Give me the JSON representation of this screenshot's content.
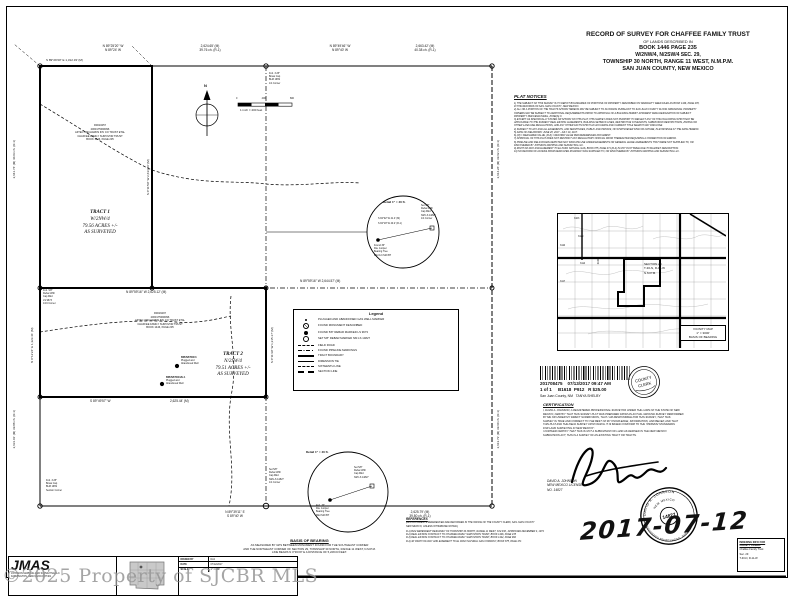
{
  "sheet": {
    "watermark": "©2025 Property of SJCBR MLS"
  },
  "title_block": {
    "line1": "RECORD OF SURVEY FOR CHAFFEE FAMILY TRUST",
    "line2": "OF LANDS DESCRIBED IN",
    "line3": "BOOK 1446 PAGE 235",
    "line4": "W/2NW/4, N/2SW/4 SEC. 29,",
    "line5": "TOWNSHIP 30 NORTH, RANGE 11 WEST, N.M.P.M.",
    "line6": "SAN JUAN COUNTY, NEW MEXICO"
  },
  "plat_notices": {
    "header": "PLAT NOTICES",
    "lines": [
      "1) THE SUBJECT OF THIS SURVEY IS TO DEPICT BOUNDARIES OF PORTIONS OF PROPERTY DESCRIBED ON WARRANTY DEED FILED AS BOOK 1446, PAGE 235,",
      "IN THE RECORDS OF SAN JUAN COUNTY, NEW MEXICO.",
      "2) ALL OR A PORTION OF THE TRACTS SHOWN HEREON MAY BE SUBJECT TO FLOODING PURSUANT TO SAN JUAN COUNTY FLOOD ORDINANCE. PROPERTY",
      "OWNERS MAY BE SUBJECT TO ADDITIONAL REQUIREMENTS PRIOR TO APPROVAL OF A BUILDING PERMIT. APPARENT FEMA DESIGNATION OF SUBJECT",
      "PROPERTY PER FEMA PANEL, ZONE(S) X.",
      "3) EXCEPT AS SPECIFICALLY STATED OR SHOWN ON THIS PLAT, THIS SURVEY DOES NOT PURPORT TO REFLECT ANY OF THE FOLLOWING WHICH MAY BE",
      "APPLICABLE TO THE SUBJECT REAL ESTATE: EASEMENTS, BUILDING SETBACK LINES, RESTRICTIVE COVENANTS, SUBDIVISION RESTRICTIONS, ZONING OR",
      "OTHER LAND-USE REGULATIONS, AND ANY OTHER FACTS WHICH AN ACCURATE AND CURRENT TITLE SEARCH MAY DISCLOSE.",
      "4) SUBJECT TO ANY AND ALL EASEMENTS, AND SERVITUDES, PUBLIC AND PRIVATE, OF WHATSOEVER KIND OR NATURE, IN EXISTENCE AT THE DATE HEREOF.",
      "5) DATE OF FIELDWORK: JUNE 28, 2017 - JULY 10, 2017.",
      "6) (M) = MEASURED VALUE, (R-#) = RECORD VALUE PER REFERENCED DOCUMENT.",
      "7) APPROVAL OF THIS PLAT DOES NOT RESTRICT ANY REGULATORY OFFICIAL FROM THEREAFTER REQUIRING A CORRECTION OF ERROR.",
      "8) PIPELINE AND FIELD ROADS DEPICTED MAY INDICATE USE UNDER EASEMENTS OR GENERAL LEASE AGREEMENTS THAT WERE NOT SUPPLIED TO, OR",
      "DISCOVERED BY JOHNSON MAPPING AND SURVEYING LLC.",
      "9) RIGHT-OF-WAY AND EASEMENT TO EL PASO NATURAL GAS, BOOK 875, PAGE 471 (R-4) IS NOT PLOTTABLE DUE TO BLANKET DESCRIPTION.",
      "10) NO RECORD OF ACCESS FROM DEDICATED ROADWAY WAS SUPPLIED TO, OR DISCOVERED BY JOHNSON MAPPING AND SURVEYING LLC."
    ]
  },
  "vicinity_map": {
    "section_line1": "SECTION 29",
    "section_line2": "T-30-N, R-11-W",
    "section_line3": "N.M.P.M.",
    "caption_line1": "VICINITY MAP",
    "caption_line2": "1\" = 3000'",
    "caption_line3": "BASIS OF BEARING",
    "road_numbers": [
      "3103",
      "3129",
      "3110",
      "3114",
      "3100",
      "3117"
    ]
  },
  "recording_stamp": {
    "doc_number": "201708475",
    "datetime": "07/13/2017 09:47 AM",
    "pages": "1 of 1",
    "book": "B1618",
    "page": "P912",
    "fee": "R $25.00",
    "county": "San Juan County, NM",
    "clerk": "TANYA SHELBY",
    "seal_line1": "COUNTY",
    "seal_line2": "CLERK"
  },
  "certification": {
    "header": "CERTIFICATION",
    "lines": [
      "I, DAVID A. JOHNSON, A REGISTERED PROFESSIONAL SURVEYOR UNDER THE LAWS OF THE STATE OF NEW",
      "MEXICO, CERTIFY THAT THIS SURVEY PLAT WAS PREPARED FROM AN ACTUAL GROUND SURVEY PERFORMED",
      "BY ME OR UNDER MY DIRECT SUPERVISION, THAT I AM RESPONSIBLE FOR THIS SURVEY, THAT THIS",
      "SURVEY IS TRUE AND CORRECT TO THE BEST OF MY KNOWLEDGE, INFORMATION, AND BELIEF, AND THAT",
      "THIS PLAT AND THE FIELD SURVEY UPON WHICH IT IS BASED CONFORM TO THE \"MINIMUM STANDARDS",
      "FOR LAND SURVEYING IN NEW MEXICO\".",
      "I FURTHER CERTIFY THAT THIS IS NOT A SUBDIVISION OF LAND AS DEFINED IN THE NEW MEXICO",
      "SUBDIVISION ACT; THIS IS A SURVEY OF AN EXISTING TRACT OR TRACTS."
    ]
  },
  "surveyor": {
    "name": "DAVID A. JOHNSON",
    "license_line": "NEW MEXICO LICENSE",
    "license_no": "NO. 14827",
    "seal_name": "DAVID A. JOHNSON",
    "seal_state": "NEW MEXICO",
    "seal_number": "14827",
    "seal_title": "REGISTERED PROFESSIONAL SURVEYOR",
    "signed_date": "2017-07-12"
  },
  "indexing_box": {
    "line1": "INDEXING INFO FOR",
    "line2": "COUNTY CLERK:",
    "line3": "Chaffee Family Trust",
    "line4": "Sec. 29",
    "line5": "T-30-N, R-11-W"
  },
  "references": {
    "header": "REFERENCES",
    "intro": [
      "(ALL DOCUMENTS REFERENCED ARE RECORDED IN THE OFFICE OF THE COUNTY CLERK, SAN JUAN COUNTY",
      "NEW MEXICO, UNLESS OTHERWISE NOTED.)"
    ],
    "lines": [
      "R-1) BLM DEPENDENT RESURVEY OF TOWNSHIP 30 NORTH, RANGE 11 WEST, N.M.P.M., APPROVED DECEMBER 4, 1974",
      "R-2) REAL ESTATE CONTRACT TO CHAFFEE FAMILY SURVIVOR'S TRUST, BOOK 1446, PAGE 235",
      "R-3) REAL ESTATE CONTRACT TO CHAFFEE FAMILY SURVIVOR'S TRUST, BOOK 1442, PAGE 960",
      "R-4) 40' RIGHT-OF-WAY AND EASEMENT TO EL PASO NATURAL GAS COMPANY, BOOK 875, PAGE 471"
    ]
  },
  "basis_of_bearing": {
    "header": "BASIS OF BEARING",
    "lines": [
      "AS MEASURED BY GPS BETWEEN MONUMENT FOUND FOR THE SOUTHEAST CORNER",
      "AND THE NORTHEAST CORNER OF SECTION 29, TOWNSHIP 30 NORTH, RANGE 11 WEST, N.M.P.M.",
      "LINE BEARS N 0°36'29\" E   A DISTANCE OF 5,228.03 FEET."
    ]
  },
  "firm_block": {
    "abbr": "JMAS",
    "name": "JOHNSON MAPPING AND SURVEYING LLC",
    "city": "FARMINGTON, NEW MEXICO 87401",
    "drawn_label": "DRAWN BY",
    "drawn": "DAJ",
    "date_label": "DATE",
    "date": "07/12/2017",
    "scale_label": "SCALE",
    "scale": "1\" = 400'"
  },
  "plat": {
    "north_label": "N",
    "scale_caption": "1 inch = 400 feet",
    "scale_ticks": [
      "0",
      "400",
      "800"
    ],
    "tract1": {
      "title": "TRACT 1",
      "aliquot": "W/2NW/4",
      "area": "79.56 ACRES +/-",
      "note": "AS SURVEYED",
      "owner": [
        "R0010257",
        "2060175096096",
        "AZTEC ORCHARDS INV CO TRUST ETAL",
        "CHAFFEE FAMILY SURVIVOR TRUST",
        "BOOK 1446, PAGE 235"
      ]
    },
    "tract2": {
      "title": "TRACT 2",
      "aliquot": "N/2SW/4",
      "area": "79.51 ACRES +/-",
      "note": "AS SURVEYED",
      "owner": [
        "R0016297",
        "2060175096096",
        "AZTEC ORCHARDS INV CO TRUST ETAL",
        "CHAFFEE FAMILY SURVIVOR TRUST",
        "BOOK 1446, PAGE 235"
      ]
    },
    "labels": {
      "north_tie": "S 89°29'30\" E   1,312.33' (M)",
      "north_w_bearing_m": "N 89°25'20\" W",
      "north_w_bearing_r": "N 89°24' W",
      "north_w_dist_m": "2,624.65' (M)",
      "north_w_dist_r": "39.76 ch. (R-1)",
      "north_e_bearing_m": "N 89°49'46\" W",
      "north_e_bearing_r": "N 89°40' W",
      "north_e_dist_m": "2,663.42' (M)",
      "north_e_dist_r": "40.38 ch. (R-1)",
      "quarter_line": "N 89°59'16\" W    2,644.57' (M)",
      "tract1_east": "S 0°11'59\" W    2,634.20' (M)",
      "tract2_north": "N 89°59'16\" W    2,625.12' (M)",
      "tract2_south_bearing": "S 89°49'57\" W",
      "tract2_south_dist": "2,625.44' (M)",
      "tract2_east": "S 0°11'39\" W    1,315.17' (M)",
      "tract2_west": "N 0°12'24\" E    1,323.41' (M)",
      "west_north": "2,641.74' (M)   40.03 ch. (R-1)",
      "west_south": "2,631.01' (M)   39.88 ch. (R-1)",
      "east_north": "2,614.26' (M)   39.62 ch. (R-1)",
      "east_south": "2,613.73' (M)   39.60 ch. (R-1)",
      "south_bearing_m": "N 89°39'11\" E",
      "south_bearing_r": "S 89°40' W",
      "south_dist_m": "2,625.79' (M)",
      "south_dist_r": "39.80 ch. (R-1)"
    },
    "monuments": {
      "quarter_north": [
        "Fnd. 3.25\"",
        "Brass Cap",
        "BLM 1969",
        "1/4 Corner"
      ],
      "sw_corner": [
        "Fnd. 3.25\"",
        "Brass Cap",
        "BLM 1969",
        "Section Corner"
      ],
      "sixteenth_west": [
        "Fnd. 5/8\"",
        "Rebar With",
        "Cap Mkd",
        "LS 9673",
        "1/16 Corner"
      ],
      "quarter_south": [
        "Set 5/8\"",
        "Rebar With",
        "Cap Mkd",
        "NM-LS 14827",
        "1/4 Corner"
      ]
    },
    "wells": [
      {
        "name": "BRUNSTON 3",
        "line2": "Plugged and",
        "line3": "Abandoned Well"
      },
      {
        "name": "BRUNSTON 2H-1",
        "line2": "Plugged and",
        "line3": "Abandoned Well"
      }
    ],
    "legend": {
      "title": "Legend",
      "items": [
        {
          "label": "PLUGGED AND ABANDONED GAS WELL MARKER"
        },
        {
          "label": "FOUND MONUMENT DESCRIBED"
        },
        {
          "label": "FOUND 5/8\" REBAR MARKED LS 9673"
        },
        {
          "label": "SET 5/8\" REBAR MARKED NM LS 14827"
        },
        {
          "label": "FIELD ROAD"
        },
        {
          "label": "FOUND PIPELINE MARKINGS"
        },
        {
          "label": "TRACT BOUNDARY"
        },
        {
          "label": "DIMENSION TIE"
        },
        {
          "label": "SIXTEENTH LINE"
        },
        {
          "label": "SECTION LINE"
        }
      ]
    },
    "detail1": {
      "title": "Detail 1\" = 40 ft.",
      "tie1": "S 84°02' W  41.4' (M)",
      "tie2": "S 84°18' W  40.2' (R-1)",
      "left_note": [
        "Found 36\"",
        "Dia. Juniper",
        "Bearing Tree",
        "Mkd 1/4 S29 BT"
      ],
      "right_note": [
        "Set 5/8\"",
        "Rebar With",
        "Cap Mkd",
        "NM LS 14827",
        "1/4 Corner"
      ]
    },
    "detail2": {
      "title": "Detail 1\" = 40 ft.",
      "left_note": [
        "Fnd. 36\"",
        "Dia. Juniper",
        "Bearing Tree",
        "Mkd S29 BT"
      ],
      "right_note": [
        "Set 5/8\"",
        "Rebar With",
        "Cap Mkd",
        "NM LS 14827"
      ]
    }
  }
}
